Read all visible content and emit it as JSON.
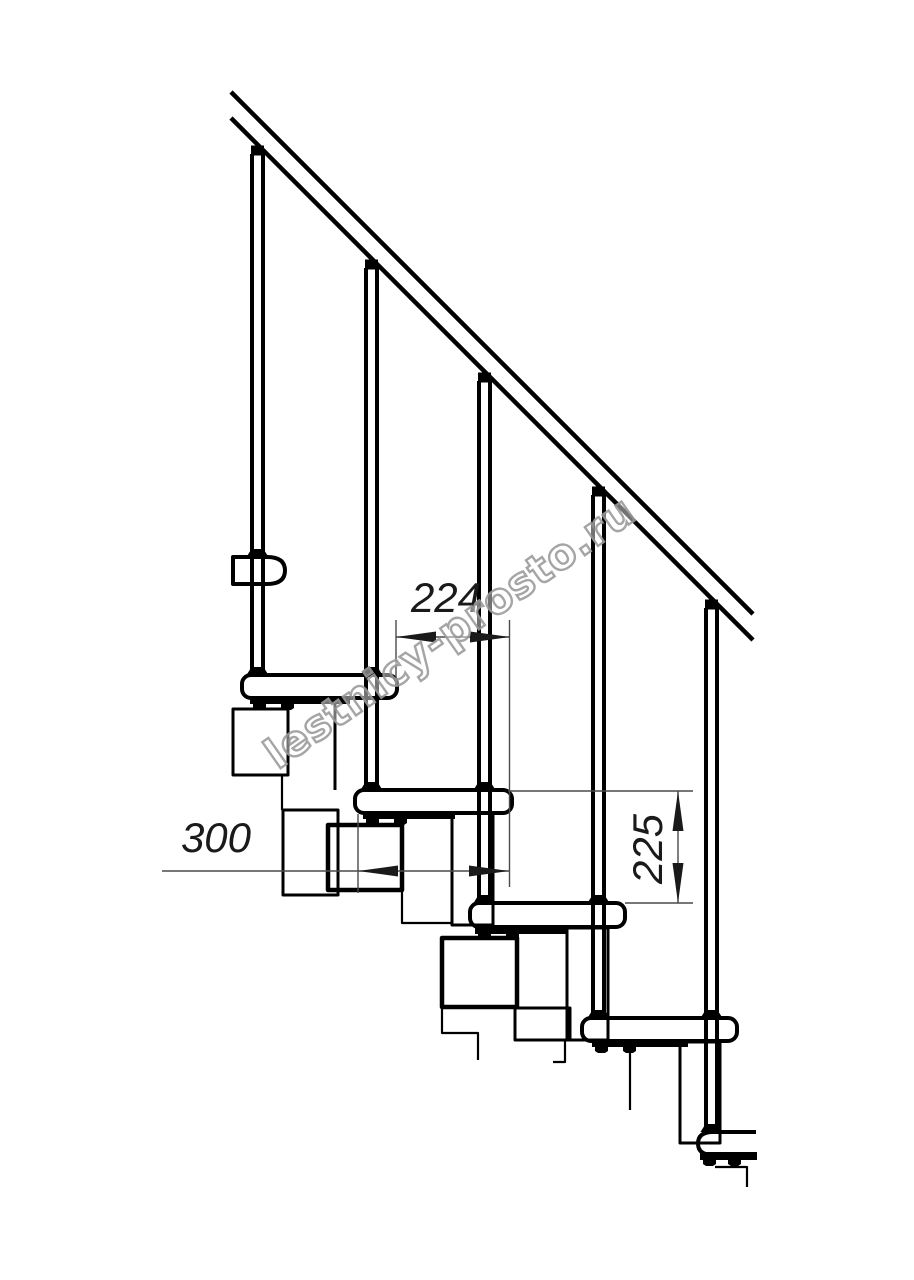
{
  "canvas": {
    "background": "#ffffff",
    "line_color": "#000000",
    "dimension_line_color": "#4a4a4a",
    "dimension_text_color": "#1a1a1a"
  },
  "watermark": {
    "text": "lestnicy-prosto.ru",
    "color": "#9c9c9c"
  },
  "dimensions": {
    "run": {
      "value": "224",
      "orientation": "horizontal"
    },
    "tread_length": {
      "value": "300",
      "orientation": "horizontal"
    },
    "rise": {
      "value": "225",
      "orientation": "vertical"
    }
  }
}
